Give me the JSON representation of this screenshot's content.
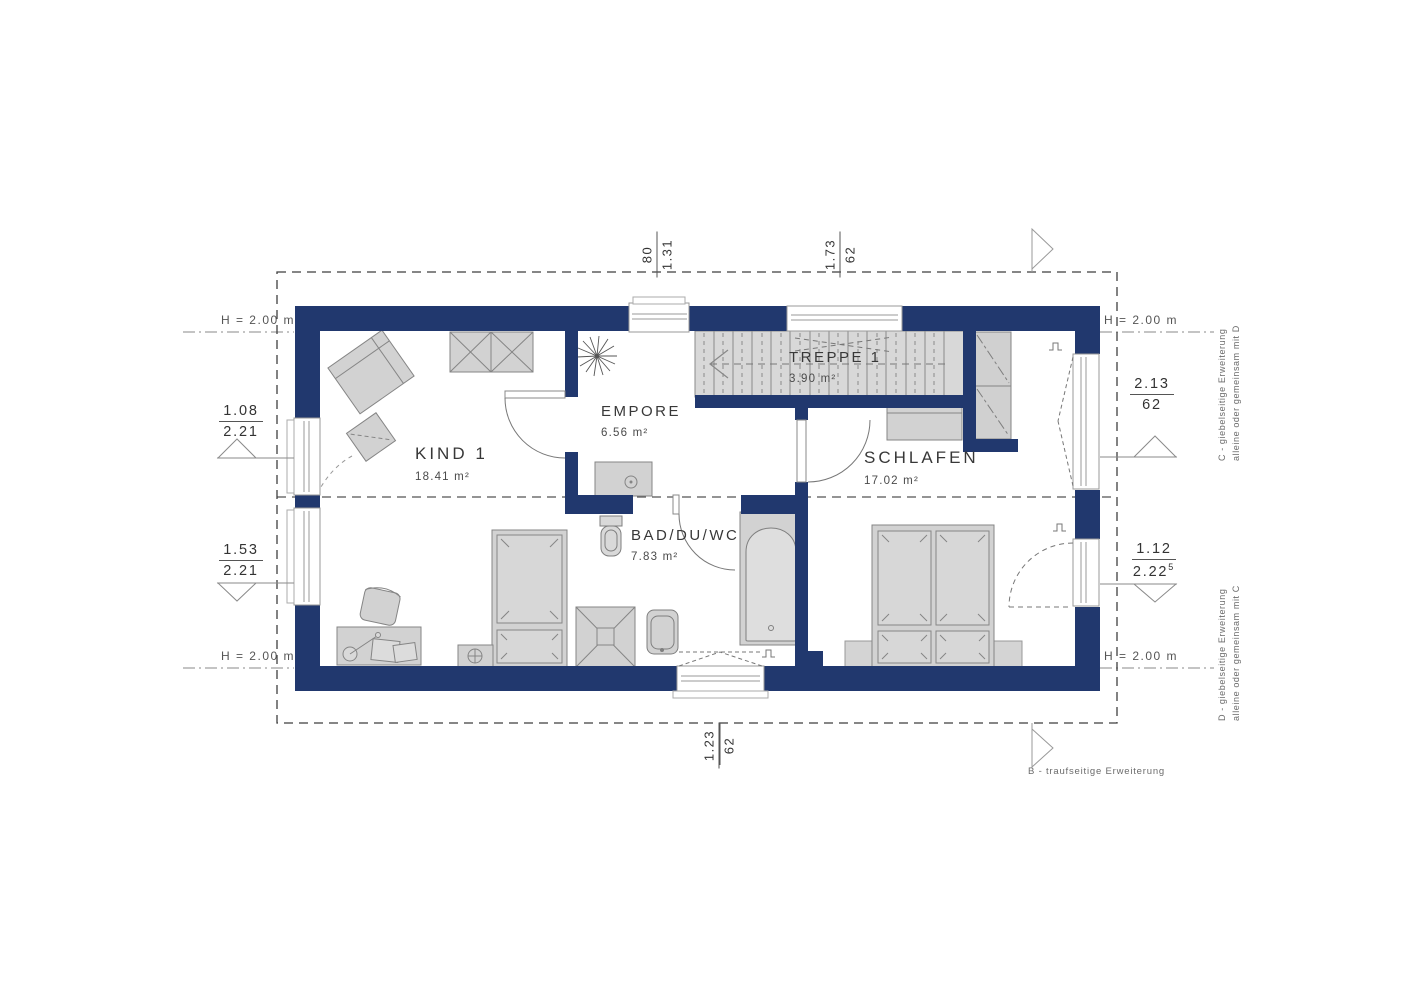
{
  "rooms": [
    {
      "name": "KIND 1",
      "area": "18.41 m²"
    },
    {
      "name": "EMPORE",
      "area": "6.56 m²"
    },
    {
      "name": "TREPPE 1",
      "area": "3.90 m²"
    },
    {
      "name": "SCHLAFEN",
      "area": "17.02 m²"
    },
    {
      "name": "BAD/DU/WC",
      "area": "7.83 m²"
    }
  ],
  "height_labels": [
    "H = 2.00 m",
    "H = 2.00 m",
    "H = 2.00 m",
    "H = 2.00 m"
  ],
  "dimensions": {
    "top": [
      {
        "a": "80",
        "b": "1.31"
      },
      {
        "a": "1.73",
        "b": "62"
      }
    ],
    "bottom": [
      {
        "a": "1.23",
        "b": "62"
      }
    ],
    "left": [
      {
        "a": "1.08",
        "b": "2.21"
      },
      {
        "a": "1.53",
        "b": "2.21"
      }
    ],
    "right": [
      {
        "a": "2.13",
        "b": "62"
      },
      {
        "a": "1.12",
        "b": "2.22",
        "sup": "5"
      }
    ]
  },
  "notes": {
    "c_line1": "C - giebelseitige Erweiterung",
    "c_line2": "alleine oder gemeinsam mit D",
    "d_line1": "D - giebelseitige Erweiterung",
    "d_line2": "alleine oder gemeinsam mit C",
    "b_note": "B - traufseitige Erweiterung"
  },
  "colors": {
    "wall": "#21386e",
    "furniture_fill": "#d2d2d2",
    "line": "#8a8a8a",
    "text": "#3a3a3a"
  }
}
